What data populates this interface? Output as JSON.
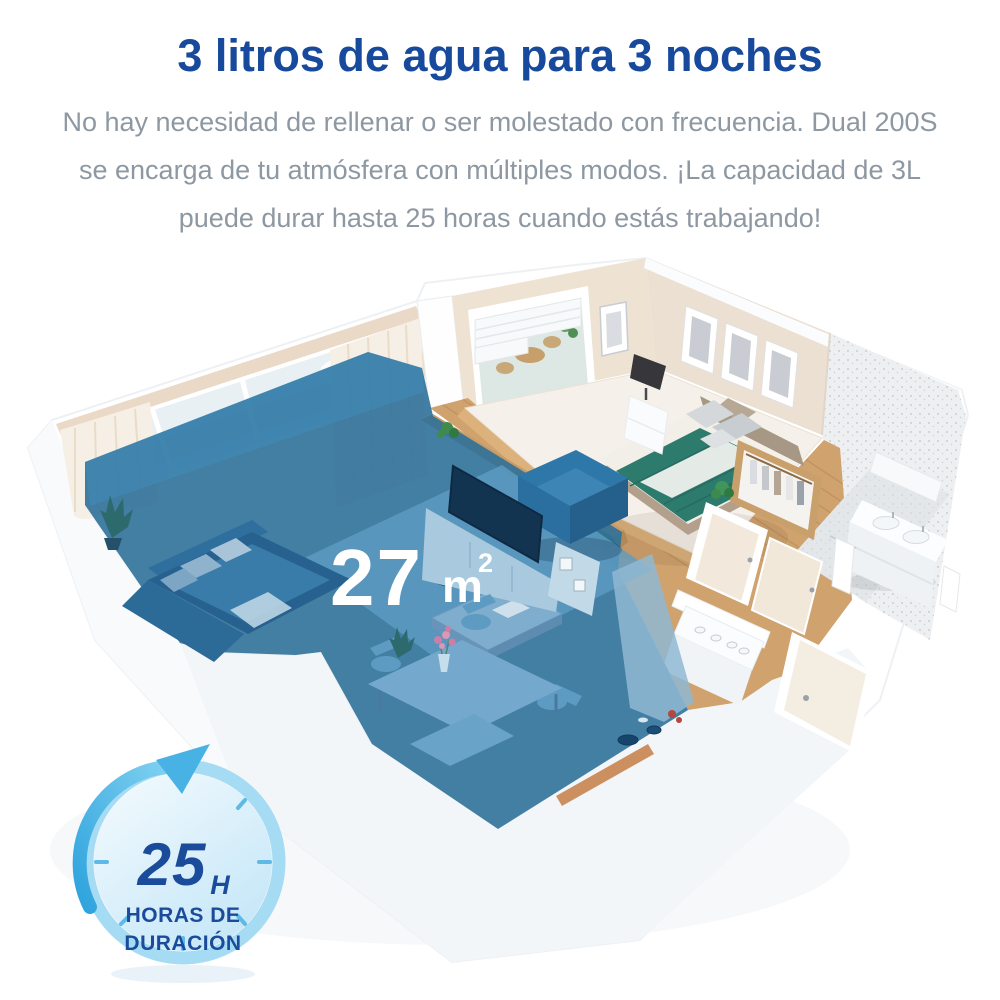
{
  "header": {
    "title": "3 litros de agua para 3 noches",
    "subtitle_lines": [
      "No hay necesidad de rellenar o ser molestado con frecuencia. Dual 200S",
      "se encarga de tu atmósfera con múltiples modos. ¡La capacidad de 3L",
      "puede durar hasta 25 horas cuando estás trabajando!"
    ]
  },
  "floorplan": {
    "illustration": "isometric-apartment-floorplan",
    "area_value": "27",
    "area_unit": "m",
    "area_exponent": "2"
  },
  "badge": {
    "icon": "circular-arrow-timer-icon",
    "value": "25",
    "unit": "H",
    "caption_line1": "HORAS DE",
    "caption_line2": "DURACIÓN"
  },
  "colors": {
    "title_blue": "#17499c",
    "subtitle_gray": "#8d98a2",
    "overlay_blue": "#2f7099",
    "badge_ring": "#a5dcf4",
    "badge_arrow": "#49b2e5",
    "badge_text": "#1a4c9b",
    "duvet_teal": "#2d7b6d",
    "wood_floor": "#d0a26d"
  }
}
